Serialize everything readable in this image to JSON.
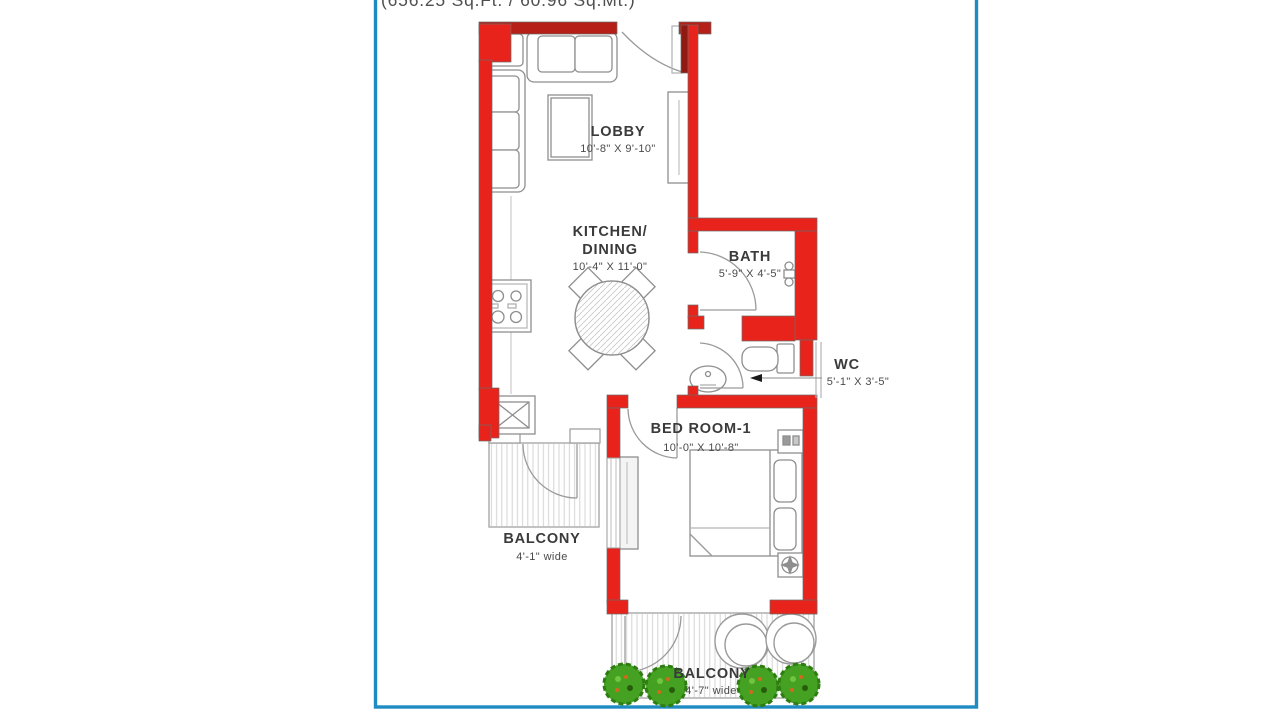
{
  "document": {
    "type": "apartment-unit-floor-plan",
    "caption_top_clipped": "(656.25 Sq.Ft. / 60.96 Sq.Mt.)"
  },
  "rooms": {
    "lobby": {
      "name": "LOBBY",
      "dims": "10'-8\" X 9'-10\""
    },
    "kitchen": {
      "name_line1": "KITCHEN/",
      "name_line2": "DINING",
      "dims": "10'-4\" X 11'-0\""
    },
    "bath": {
      "name": "BATH",
      "dims": "5'-9\" X 4'-5\""
    },
    "wc": {
      "name": "WC",
      "dims": "5'-1\" X 3'-5\""
    },
    "bedroom": {
      "name": "BED ROOM-1",
      "dims": "10'-0\" X 10'-8\""
    },
    "balcony_left": {
      "name": "BALCONY",
      "dims": "4'-1\" wide"
    },
    "balcony_bottom": {
      "name": "BALCONY",
      "dims": "4'-7\" wide"
    }
  },
  "colors": {
    "wall_red": "#e8231c",
    "wall_red_dark": "#b51f17",
    "frame_blue": "#1e8bc3",
    "line_gray": "#8e8e8e",
    "hatch_gray": "#d4d4d4",
    "plant_green": "#44a122",
    "plant_green_dark": "#2e7d11",
    "plant_accent_orange": "#d2691e",
    "text_dark": "#3a3a3a"
  }
}
